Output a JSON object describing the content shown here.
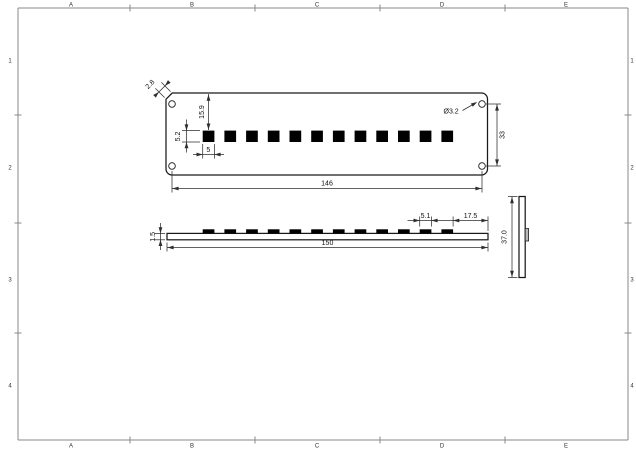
{
  "frame": {
    "columns": [
      "A",
      "B",
      "C",
      "D",
      "E"
    ],
    "rows": [
      "1",
      "2",
      "3",
      "4"
    ]
  },
  "top_view": {
    "dims": {
      "chamfer": "2.8",
      "slot_offset_top": "15.9",
      "slot_height": "5.2",
      "slot_width": "5",
      "hole_diameter": "Ø3.2",
      "hole_pitch_vertical": "33",
      "hole_pitch_horizontal": "146"
    },
    "slot_count": 12,
    "hole_count": 4
  },
  "front_view": {
    "dims": {
      "thickness": "1.5",
      "length": "150",
      "tab_width": "5.1",
      "tab_edge_offset": "17.5"
    },
    "tab_count": 12
  },
  "end_view": {
    "dims": {
      "height": "37.0"
    }
  },
  "colors": {
    "background": "#ffffff",
    "object_line": "#1a1a1a",
    "dimension_line": "#2e2e2e",
    "frame_line": "#8a8a8a",
    "tab_fill": "#b8b8b8"
  }
}
